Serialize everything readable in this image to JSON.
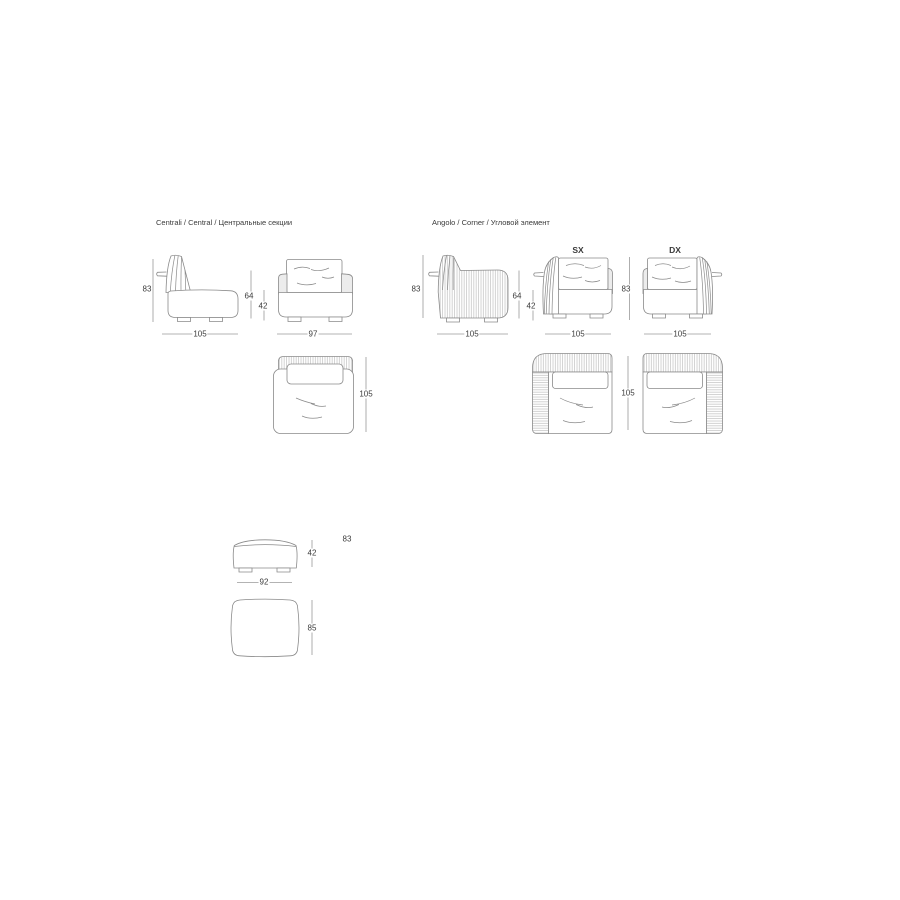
{
  "colors": {
    "background": "#ffffff",
    "line": "#8a8a8a",
    "dim_line": "#9a9a9a",
    "text": "#3a3a3a",
    "hatch": "#c0c0c0",
    "shade": "#ececec"
  },
  "sections": {
    "central": {
      "title": "Centrali / Central / Центральные секции",
      "dims": {
        "side_height": "83",
        "side_depth": "105",
        "back_height": "64",
        "seat_height": "42",
        "front_width": "97",
        "top_depth": "105"
      }
    },
    "corner": {
      "title": "Angolo / Corner / Угловой элемент",
      "variant_left": "SX",
      "variant_right": "DX",
      "dims": {
        "side_height": "83",
        "side_depth": "105",
        "back_height": "64",
        "seat_height": "42",
        "sx_front_width": "105",
        "front_height": "83",
        "dx_front_width": "105",
        "top_depth": "105"
      }
    },
    "pouf": {
      "dims": {
        "front_height": "42",
        "note_height": "83",
        "front_width": "92",
        "top_depth": "85"
      }
    }
  }
}
